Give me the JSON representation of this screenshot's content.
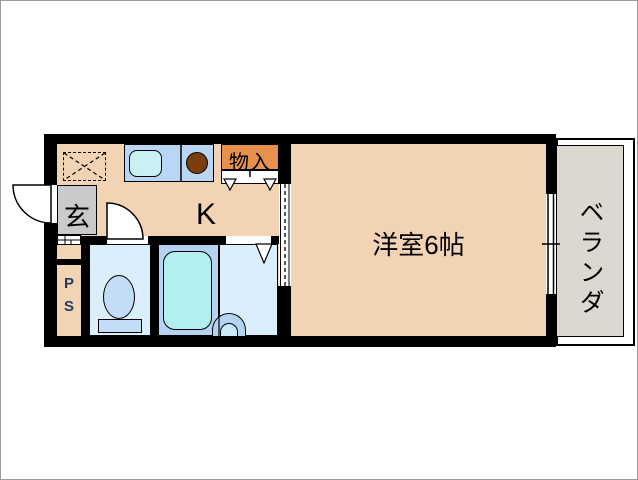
{
  "floorplan": {
    "title": "1K apartment floor plan",
    "labels": {
      "entrance": "玄",
      "kitchen": "K",
      "storage": "物入",
      "main_room": "洋室6帖",
      "veranda": "ベランダ",
      "pipe_space": "P\nS"
    },
    "colors": {
      "wall": "#000000",
      "floor": "#F2D4B4",
      "storage": "#E8914E",
      "entrance_floor": "#CACACA",
      "veranda_floor": "#DCD7CF",
      "counter": "#B9D6F5",
      "wet_room": "#DBEEFB",
      "tub_area": "#B4D2F2",
      "tub": "#B2F0F0",
      "sink": "#C9F0F2",
      "burner": "#7B3D0E",
      "fixture": "#C3DDF8",
      "basin_inner": "#C9E9FA",
      "ps_text": "#223A66"
    }
  }
}
